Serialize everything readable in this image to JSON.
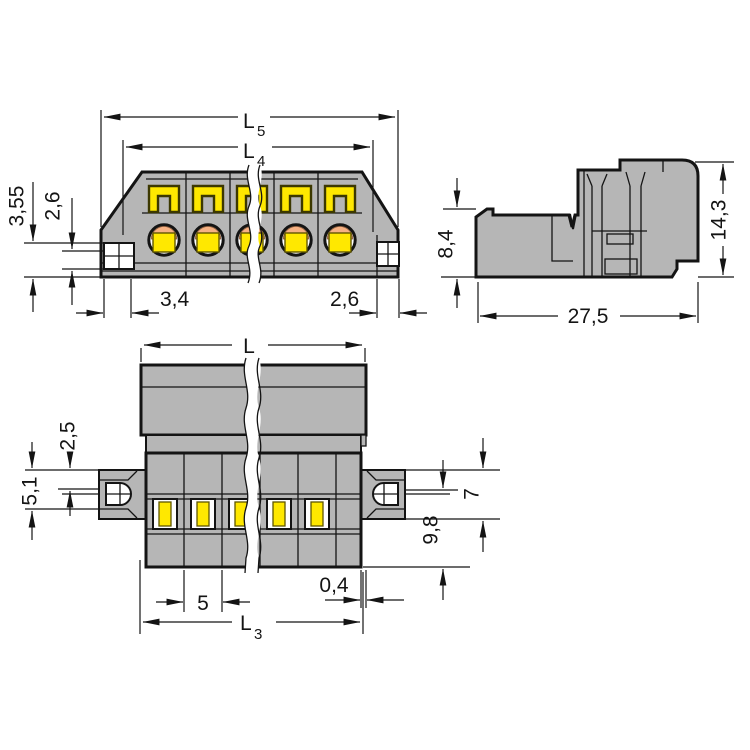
{
  "drawing_title": "terminal-block-connector-dimensional-drawing",
  "colors": {
    "bg": "#ffffff",
    "body": "#b6b6b6",
    "yellow": "#ffe800",
    "salmon": "#f6b183",
    "line": "#141414"
  },
  "views": {
    "front": {
      "dims": {
        "overall_width": {
          "main": "L",
          "sub": "5"
        },
        "mount_width": {
          "main": "L",
          "sub": "4"
        },
        "entry_outer": "3,55",
        "entry_inner": "2,6",
        "end_left": "3,4",
        "end_right": "2,6"
      }
    },
    "side": {
      "dims": {
        "lower_height": "8,4",
        "total_height": "14,3",
        "depth": "27,5"
      }
    },
    "plan": {
      "dims": {
        "length": "L",
        "mount_length": {
          "main": "L",
          "sub": "3"
        },
        "flange_upper": "2,5",
        "flange_full": "5,1",
        "flange_height": "7",
        "body_depth": "9,8",
        "pole_pitch": "5",
        "edge_offset": "0,4"
      }
    }
  }
}
